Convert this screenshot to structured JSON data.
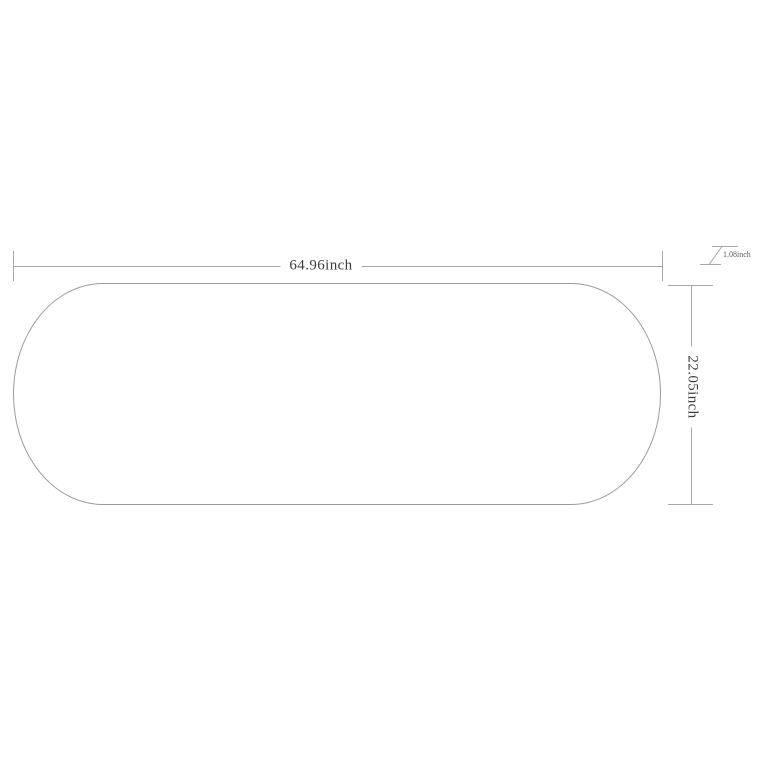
{
  "page": {
    "background_color": "#ffffff",
    "type": "product-dimension-diagram",
    "object_shown": "oval-tabletop-outline"
  },
  "drawing": {
    "colors": {
      "shape_outline": "#9b9b9b",
      "dimension_lines": "#a8a8a8",
      "label_text": "#3d3d3d"
    },
    "dimensions": {
      "width": {
        "label": "64.96inch",
        "value": 64.96,
        "unit": "inch",
        "placement": "top-horizontal"
      },
      "depth": {
        "label": "22.05inch",
        "value": 22.05,
        "unit": "inch",
        "placement": "right-vertical-rotated"
      },
      "thickness": {
        "label": "1.08inch",
        "value": 1.08,
        "unit": "inch",
        "placement": "top-right-section-symbol"
      }
    }
  }
}
